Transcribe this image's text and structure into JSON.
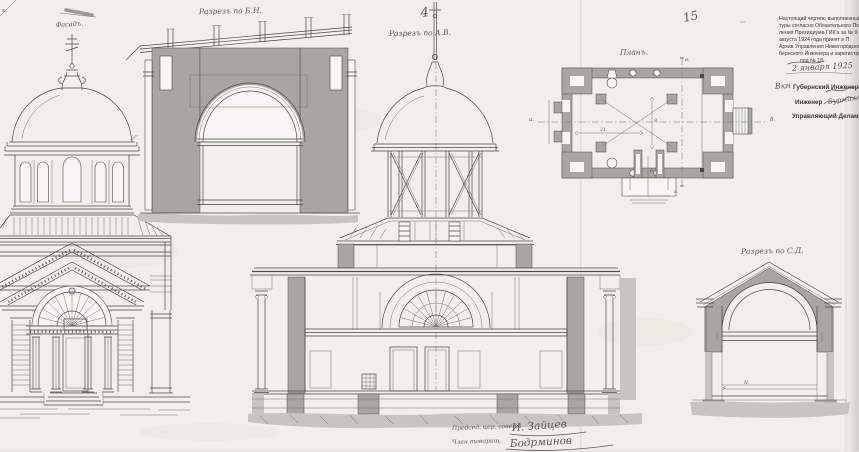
{
  "titles": {
    "facade": "Фасадъ.",
    "section_bn": "Разрезъ по Б.Н.",
    "section_ab": "Разрезъ по А.В.",
    "plan": "Планъ.",
    "section_cd": "Разрезъ по С.Д."
  },
  "stamp": {
    "lines": [
      "Настоящий чертеж, выполненный",
      "туры согласно Обязательного По",
      "ления Президиума ГИК'а за № 9",
      "августа 1924 года принят в П",
      "Архив Управления Нижегородско",
      "бернского Инженера и зарегистри",
      "под № 18"
    ],
    "date_handwritten": "2 января 1925",
    "officials": {
      "prefix_handwritten": "Вкн",
      "line1": "Губернский Инженер",
      "line2": "Инженер",
      "line2_signature": "Бурмил.",
      "line3": "Управляющий Делами"
    }
  },
  "signatures": {
    "row1_label": "Председ. цер. совета",
    "row1_name": "И. Зайцев",
    "row2_label": "Член товарищ.",
    "row2_name": "Бодрминов"
  },
  "pencil_marks": {
    "top_center": "4",
    "top_right": "15",
    "corner_left": "х.",
    "axis_left": "а.",
    "axis_right": "б."
  },
  "plan_annotations": {
    "dim1": "21.",
    "dim2": "9.",
    "dim3": "8.",
    "axis_top": "в.",
    "axis_bottom": "г."
  },
  "dimension_cd": "N.",
  "colors": {
    "paper": "#f1efe9",
    "paperwhite": "#f7f6f2",
    "ink": "#4c4b47",
    "inklight": "#77766f",
    "poche": "#a7a6a1",
    "pochelight": "#c6c5bf",
    "pencil": "#5b5a56",
    "stampink": "#3a3936"
  }
}
